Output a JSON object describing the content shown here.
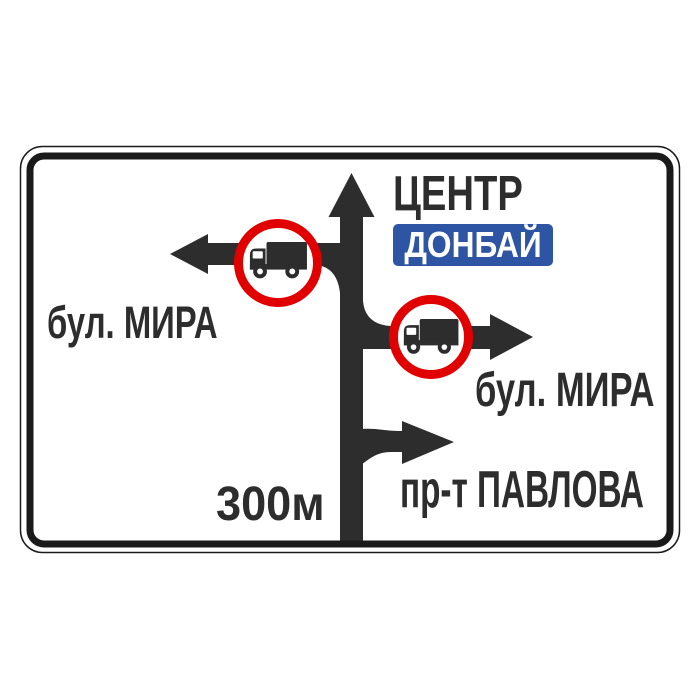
{
  "sign": {
    "kind": "road-direction-sign",
    "colors": {
      "ink": "#2d2d2d",
      "red": "#e10000",
      "blue": "#2e55a4",
      "background": "#ffffff",
      "border": "#1a1a1a"
    },
    "straight": {
      "label": "ЦЕНТР",
      "badge": "ДОНБАЙ",
      "icon": "up-arrow"
    },
    "left": {
      "label": "бул. МИРА",
      "icon": "left-arrow",
      "restriction": "no-trucks"
    },
    "right": {
      "label": "бул. МИРА",
      "icon": "right-arrow",
      "restriction": "no-trucks"
    },
    "right_far": {
      "label": "пр-т ПАВЛОВА",
      "icon": "turn-right-arrow"
    },
    "distance": "300м"
  }
}
